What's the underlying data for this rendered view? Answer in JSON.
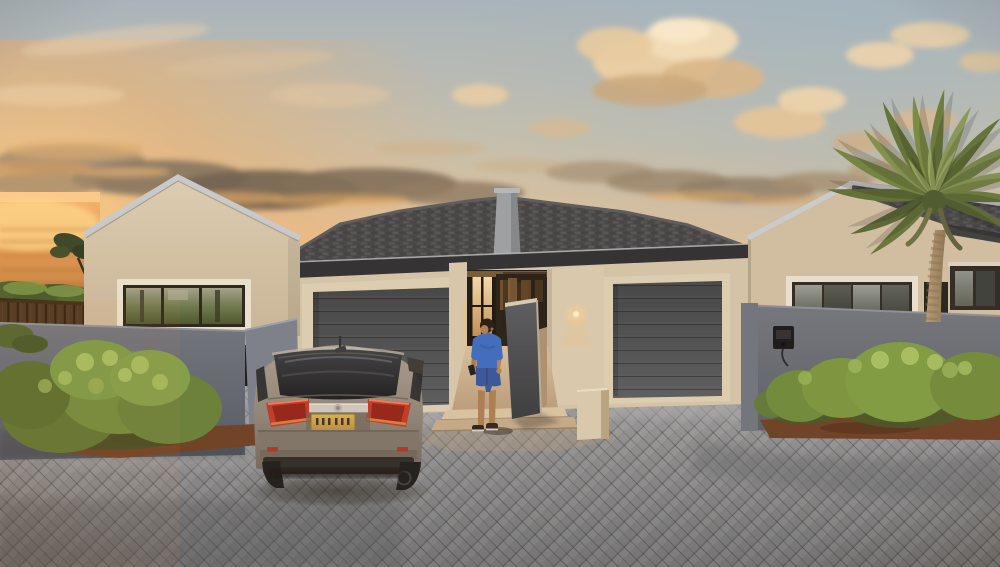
{
  "meta": {
    "type": "photograph",
    "description": "Modern beige stucco house with two gabled wings and twin charcoal garage doors at sunset; grey sedan parked on a herringbone paver driveway, a man in a blue t-shirt walking to the lit central entrance, grey privacy walls, green shrubs, a dark timber fence, a tall palm tree and golden clouds over a distant sunset horizon",
    "width_px": 1000,
    "height_px": 567
  },
  "palette": {
    "sky_top": "#a6b5c0",
    "sky_warm": "#e0c29c",
    "horizon_glow": "#f7c289",
    "sunset_orange": "#f6b873",
    "cloud_cream": "#f0ddb9",
    "cloud_gold": "#e7c091",
    "cloud_shadow": "#6e6252",
    "stucco": "#cfc0a6",
    "stucco_light": "#d8cab0",
    "roof_tile": "#45464a",
    "roof_trim": "#c6cbd1",
    "fascia_dark": "#2c2f33",
    "garage_trim": "#dccfb5",
    "garage_door": "#4d5156",
    "gray_wall": "#626a76",
    "divider_wall": "#474b52",
    "walkway_light": "#d7c4a4",
    "walkway_tan": "#c3ab8a",
    "driveway_gray": "#8a8d91",
    "mulch": "#6b4027",
    "bush_green": "#7a9a48",
    "bush_highlight": "#a9c466",
    "veg_dark": "#49592c",
    "fence_brown": "#4a3523",
    "fence_rail": "#3a2a17",
    "palm_green": "#72864a",
    "palm_trunk": "#a68e6b",
    "car_body": "#8d8479",
    "glass_dark": "#26272b",
    "tail_red": "#c0392b",
    "chrome_silver": "#cdc9c0",
    "trim_black": "#2c2b28",
    "plate_gold": "#c9a24b",
    "shirt_blue": "#3c6cc3",
    "shorts_blue": "#35569e",
    "skin_tan": "#ac7e55",
    "hair_dark": "#241d18",
    "interior_warm": "#e8c184",
    "sconce_glow": "#ffe9bf",
    "intercom_black": "#17171b"
  },
  "scene": {
    "sky": {
      "label": "sunset sky with golden clouds"
    },
    "view": {
      "label": "sunset glow over distant landscape"
    },
    "fence": {
      "label": "dark timber slat fence"
    },
    "house": {
      "label": "modern beige stucco house with two gabled wings"
    },
    "garage_left": {
      "label": "left garage with charcoal sectional door"
    },
    "garage_right": {
      "label": "right garage with charcoal sectional door"
    },
    "entrance": {
      "label": "central entrance with glass doors and warm lighting"
    },
    "divider": {
      "label": "angled grey divider wall between the two entrances"
    },
    "privacy_walls": {
      "label": "grey boundary walls with intercom"
    },
    "driveway": {
      "label": "grey herringbone paver driveway"
    },
    "bushes": {
      "label": "green shrubs with mulch beds"
    },
    "palm_tree": {
      "label": "tall palm tree"
    },
    "car": {
      "label": "grey sedan parked in front of the left garage, rear view"
    },
    "person": {
      "label": "man in blue t-shirt and shorts walking toward the entrance"
    }
  }
}
